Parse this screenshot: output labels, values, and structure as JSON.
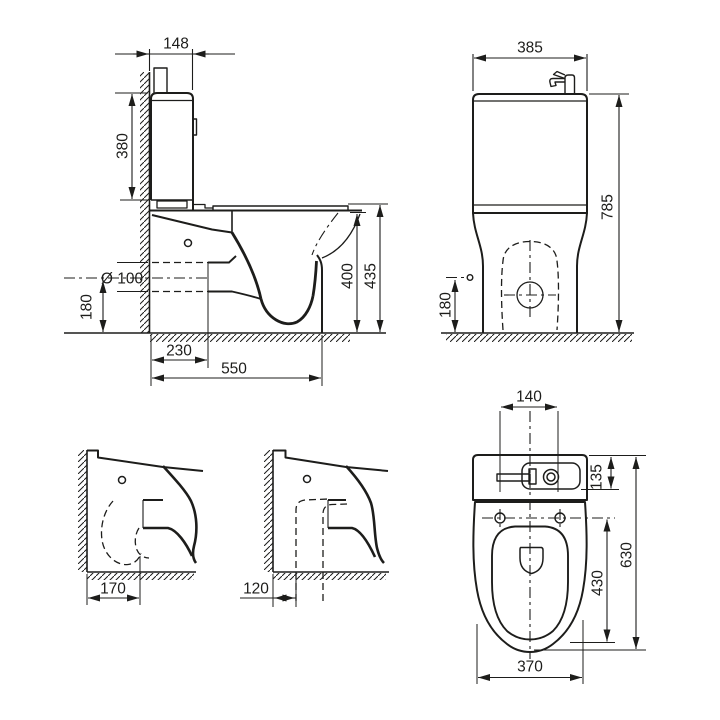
{
  "colors": {
    "line": "#1d1d1b",
    "background": "#ffffff"
  },
  "views": {
    "side": {
      "title": "side-section-view",
      "dims": {
        "cistern_depth": "148",
        "cistern_height": "380",
        "outlet_diameter": "Ø 100",
        "outlet_height": "180",
        "outlet_setback": "230",
        "total_depth": "550",
        "bowl_height": "400",
        "seat_height": "435"
      }
    },
    "front": {
      "title": "front-view",
      "dims": {
        "width": "385",
        "total_height": "785",
        "inlet_height": "180"
      }
    },
    "outlet_horizontal": {
      "title": "floor-outlet-variant",
      "dims": {
        "wall_to_outlet": "170"
      }
    },
    "outlet_vertical": {
      "title": "bottom-outlet-variant",
      "dims": {
        "wall_to_outlet": "120"
      }
    },
    "top": {
      "title": "top-view",
      "dims": {
        "tap_cutout_width": "140",
        "basin_depth": "135",
        "total_length": "630",
        "bowl_inner_length": "430",
        "bowl_width": "370"
      }
    }
  }
}
